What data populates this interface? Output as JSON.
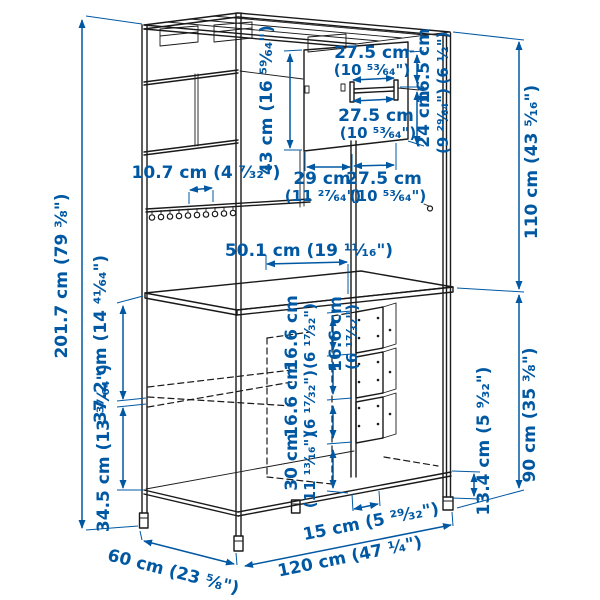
{
  "colors": {
    "dimension_blue": "#0058a3",
    "line_black": "#1a1a1a",
    "background": "#ffffff"
  },
  "diagram": {
    "type": "furniture-dimension-diagram",
    "dims": {
      "total_height": {
        "label": "201.7 cm (79 ³⁄₈\")"
      },
      "upper_section_height": {
        "label": "110 cm (43 ⁵⁄₁₆\")"
      },
      "lower_section_height": {
        "label": "90 cm (35 ³⁄₈\")"
      },
      "leg_height": {
        "label": "13.4 cm (5 ⁹⁄₃₂\")"
      },
      "total_width": {
        "label": "120 cm (47 ¹⁄₄\")"
      },
      "total_depth": {
        "label": "60 cm (23 ⁵⁄₈\")"
      },
      "base_support_width": {
        "label": "15 cm (5 ²⁹⁄₃₂\")"
      },
      "back_panel_height": {
        "label": "43 cm (16 ⁵⁹⁄₆₄\")"
      },
      "rail_width_top": {
        "cm": "27.5 cm",
        "in": "(10 ⁵³⁄₆₄\")"
      },
      "rail_width_bottom": {
        "cm": "27.5 cm",
        "in": "(10 ⁵³⁄₆₄\")"
      },
      "rail_offset_top": {
        "cm": "16.5 cm",
        "in": "(6 ¹⁄₂\")"
      },
      "rail_offset_bottom": {
        "cm": "24 cm",
        "in": "(9 ²⁹⁄₆₄\")"
      },
      "panel_width_left": {
        "cm": "29 cm",
        "in": "(11 ²⁷⁄₆₄\")"
      },
      "panel_width_right": {
        "cm": "27.5 cm",
        "in": "(10 ⁵³⁄₆₄\")"
      },
      "hook_spacing": {
        "label": "10.7 cm (4 ⁷⁄₃₂\")"
      },
      "tabletop_clear_width": {
        "label": "50.1 cm (19 ¹¹⁄₁₆\")"
      },
      "tabletop_to_rail": {
        "label": "37.2 cm (14 ⁴¹⁄₆₄\")"
      },
      "rail_to_base": {
        "label": "34.5 cm (13 ³⁷⁄₆₄\")"
      },
      "drawer_height_1": {
        "cm": "16.6 cm",
        "in": "(6 ¹⁷⁄₃₂\")"
      },
      "drawer_height_2": {
        "cm": "16.6 cm",
        "in": "(6 ¹⁷⁄₃₂\")"
      },
      "drawer_height_3": {
        "cm": "16.6 cm",
        "in": "(6 ¹⁷⁄₃₂\")"
      },
      "space_below_drawers": {
        "cm": "30 cm",
        "in": "(11 ¹³⁄₁₆\")"
      }
    }
  }
}
